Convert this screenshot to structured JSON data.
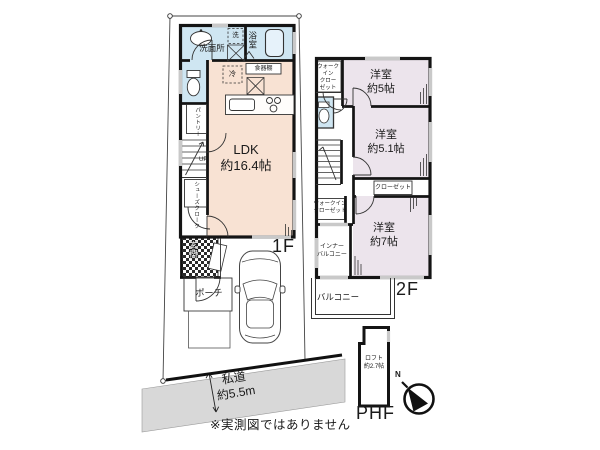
{
  "colors": {
    "wet": "#cfe6f2",
    "ldk": "#f8e2d3",
    "bedroom": "#ece4ec",
    "tub": "#e6f2fa",
    "road": "#d8d8d8"
  },
  "floor1": {
    "label": "1F",
    "ldk": {
      "name": "LDK",
      "size": "約16.4帖"
    },
    "washroom": "洗面所",
    "bath": "浴室",
    "washer": "洗",
    "fridge": "冷",
    "cupboard": "食器棚",
    "pantry": "パントリー",
    "stairs_up": "UP",
    "shoe_closet": "シューズクローク",
    "entrance": "玄関",
    "porch": "ポーチ"
  },
  "floor2": {
    "label": "2F",
    "room5": {
      "name": "洋室",
      "size": "約5帖"
    },
    "room51": {
      "name": "洋室",
      "size": "約5.1帖"
    },
    "room7": {
      "name": "洋室",
      "size": "約7帖"
    },
    "wic_top": {
      "lines": [
        "ウォーク",
        "イン",
        "クロー",
        "ゼット"
      ]
    },
    "wic_mid": {
      "lines": [
        "ウォークイン",
        "クローゼット"
      ]
    },
    "closet": "クローゼット",
    "inner_balcony": {
      "lines": [
        "インナー",
        "バルコニー"
      ]
    },
    "balcony": "バルコニー"
  },
  "phf": {
    "label": "PHF",
    "loft": {
      "name": "ロフト",
      "size": "約2.7帖"
    }
  },
  "road": {
    "name": "私道",
    "width": "約5.5m"
  },
  "compass": {
    "north": "N"
  },
  "disclaimer": "※実測図ではありません"
}
